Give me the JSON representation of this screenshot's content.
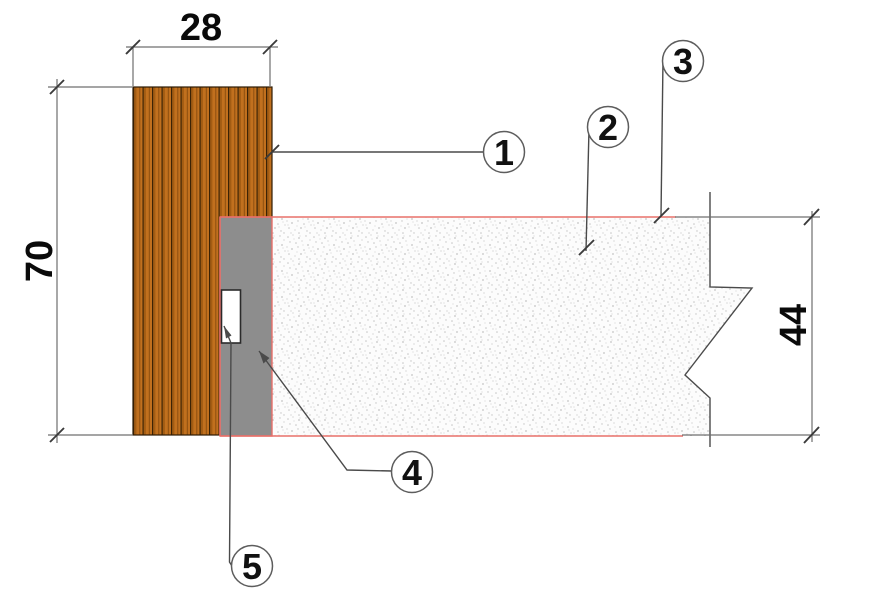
{
  "diagram": {
    "kind": "construction-detail-section",
    "dimensions": {
      "board_width": "28",
      "board_height": "70",
      "panel_depth": "44"
    },
    "callouts": [
      {
        "label": "1"
      },
      {
        "label": "2"
      },
      {
        "label": "3"
      },
      {
        "label": "4"
      },
      {
        "label": "5"
      }
    ],
    "colors": {
      "wood": "#c1701e",
      "wood_groove": "#3c2305",
      "batten_gray": "#8d8d8d",
      "outline_red": "#e8706a",
      "fixing_white": "#ffffff",
      "line_gray": "#4a4a4a",
      "speckle_bg": "#fcfcfc",
      "speckle_dot": "#9e9e9e"
    }
  }
}
